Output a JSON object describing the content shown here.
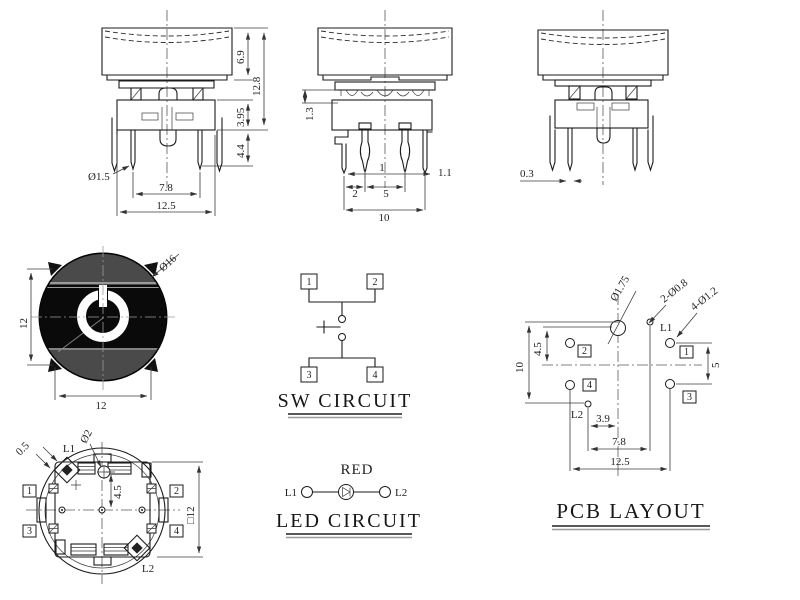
{
  "drawing": {
    "front_view": {
      "dims": {
        "cap_height": "6.9",
        "total_height": "12.8",
        "body_height": "3.95",
        "pin_length": "4.4",
        "pin_dia": "Ø1.5",
        "pin_pitch": "7.8",
        "body_width": "12.5"
      }
    },
    "side_view": {
      "dims": {
        "plate_offset": "1.3",
        "pin_w_center": "1",
        "pin_w_outer": "1.1",
        "pitch_a": "2",
        "pitch_b": "5",
        "pitch_total": "10"
      }
    },
    "rear_view": {
      "dims": {
        "pin_thk": "0.3"
      }
    },
    "top_view": {
      "dims": {
        "cap_dia": "Ø16",
        "width": "12",
        "height": "12"
      }
    },
    "bottom_view": {
      "dims": {
        "lead_w": "0.5",
        "hole_dia": "Ø2",
        "hole_offset": "4.5",
        "body_sq": "□12"
      },
      "labels": {
        "led1": "L1",
        "led2": "L2",
        "pin1": "1",
        "pin2": "2",
        "pin3": "3",
        "pin4": "4"
      }
    },
    "sw_circuit": {
      "title": "SW CIRCUIT",
      "pins": [
        "1",
        "2",
        "3",
        "4"
      ]
    },
    "led_circuit": {
      "title": "LED CIRCUIT",
      "color": "RED",
      "led1": "L1",
      "led2": "L2"
    },
    "pcb_layout": {
      "title": "PCB LAYOUT",
      "labels": {
        "led1": "L1",
        "led2": "L2",
        "pin1": "1",
        "pin2": "2",
        "pin3": "3",
        "pin4": "4"
      },
      "dims": {
        "center_hole": "Ø1.75",
        "led_holes": "2-Ø0.8",
        "pin_holes": "4-Ø1.2",
        "hole_offset": "4.5",
        "led_row_span": "10",
        "pin_row_span": "5",
        "l2_to_center": "3.9",
        "led_pitch": "7.8",
        "overall": "12.5"
      }
    }
  }
}
